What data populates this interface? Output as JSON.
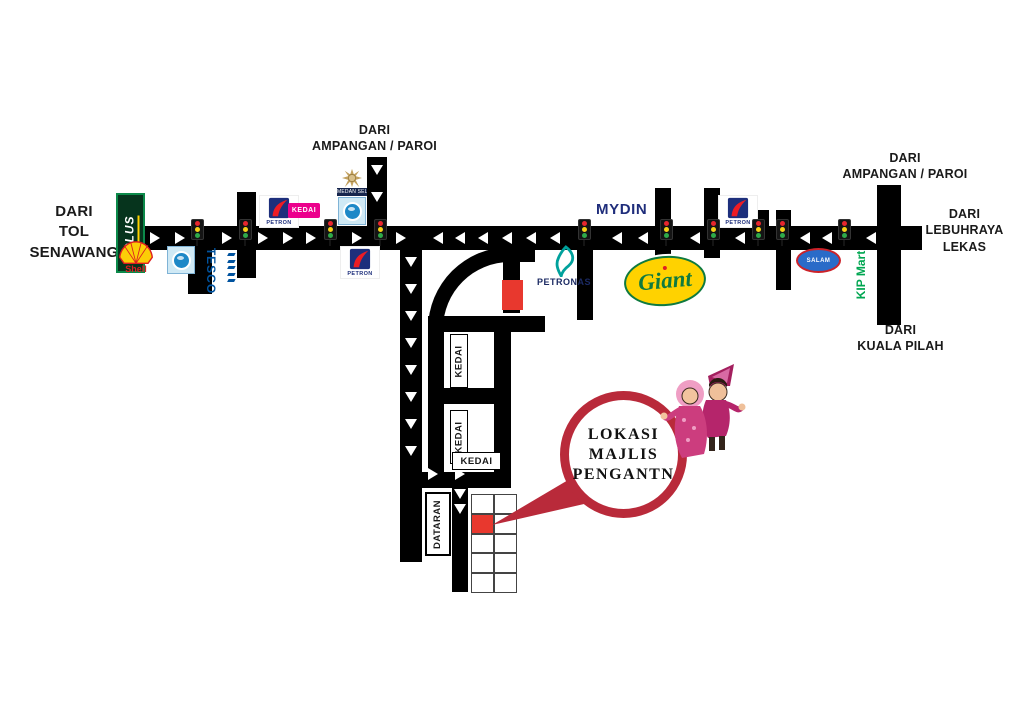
{
  "directions": {
    "tol_senawang": "DARI\nTOL\nSENAWANG",
    "ampangan_paroi_top": "DARI\nAMPANGAN / PAROI",
    "ampangan_paroi_right": "DARI\nAMPANGAN / PAROI",
    "lebuhraya_lekas": "DARI\nLEBUHRAYA\nLEKAS",
    "kuala_pilah": "DARI\nKUALA PILAH"
  },
  "landmarks": {
    "plus": "PLUS",
    "shell": "Shell",
    "tesco": "TESCO",
    "petron": "PETRON",
    "kedai_pink": "KEDAI",
    "medan_selera": "MEDAN SELERA",
    "petronas": "PETRONAS",
    "mydin": "MYDIN",
    "giant": "Giant",
    "salam": "SALAM",
    "kipmart": "KIP Mart"
  },
  "shops": {
    "kedai1": "KEDAI",
    "kedai2": "KEDAI",
    "kedai3": "KEDAI",
    "dataran": "DATARAN"
  },
  "bubble": {
    "line1": "LOKASI",
    "line2": "MAJLIS",
    "line3": "PENGANTN"
  },
  "icons": {
    "arrow_right": "▶",
    "arrow_left": "◀",
    "arrow_down": "▼",
    "traffic_light": "traffic-light",
    "state_crest": "crest",
    "food_court_plate": "plate"
  },
  "colors": {
    "road": "#000000",
    "bubble_red": "#b92a3a",
    "venue_red": "#e8382e",
    "plus_green": "#0c8a4a",
    "shell_yellow": "#fbce07",
    "shell_red": "#dd1d21",
    "tesco_blue": "#00539f",
    "petron_blue": "#1d2f7c",
    "petron_red": "#ed1c24",
    "kedai_pink": "#ec008c",
    "petronas_teal": "#00a19c",
    "mydin_blue": "#1f2d7b",
    "giant_yellow": "#ffd200",
    "giant_green": "#0f7a3f",
    "salam_blue": "#2a6bc8",
    "kipmart_green": "#00a651"
  }
}
